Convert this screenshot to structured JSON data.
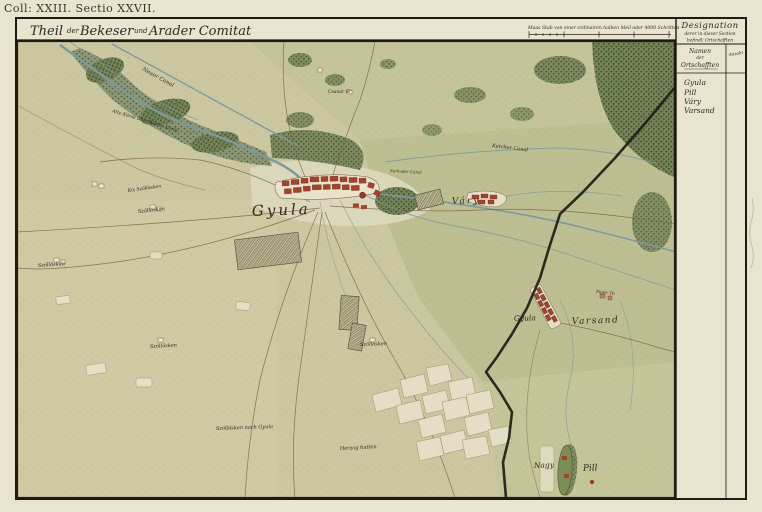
{
  "sheet": {
    "coll": "Coll: XXIII. Sectio XXVII.",
    "title": {
      "p1": "Theil",
      "p2": "der",
      "p3": "Bekeser",
      "p4": "und",
      "p5": "Arader Comitat"
    },
    "scale_text": "Maas Stab von einer ordinairen halben Meil oder 4000 Schritten"
  },
  "designation": {
    "title": "Designation",
    "subtitle1": "derer in dieser Section",
    "subtitle2": "befindl: Ortschafften",
    "col_names_1": "Namen",
    "col_names_2": "der",
    "col_names_3": "Ortschafften",
    "col_count": "Anzahl",
    "places": [
      "Gyula",
      "Pill",
      "Váry",
      "Varsand"
    ]
  },
  "map": {
    "labels": {
      "neuer_canal": "Neuer Canal",
      "alte_koros": "Alte Körös oder Weisse Körös",
      "ketcher_canal": "Ketcher Canal",
      "sarkader_canal": "Sarkader Canal",
      "csanar_er": "Csanár Er",
      "fejer_to": "Fejér To",
      "gyula": "Gyula",
      "vary": "Váry",
      "gyula_varsand_1": "Gyula",
      "gyula_varsand_2": "Varsand",
      "nagy": "Nagy",
      "pill": "Pill"
    },
    "field_labels": [
      "Szöllösken",
      "Szöllösken",
      "Szöllösken",
      "Szöllösken",
      "Szöllösken nach Gyula",
      "Herzog hutten",
      "Kis Szöllösken"
    ]
  },
  "colors": {
    "paper": "#e9e4d0",
    "terrain": "#cbc7a1",
    "water": "#7e999b",
    "forest": "#5c6b44",
    "town_red": "#a4432c",
    "boundary": "#211c14"
  }
}
